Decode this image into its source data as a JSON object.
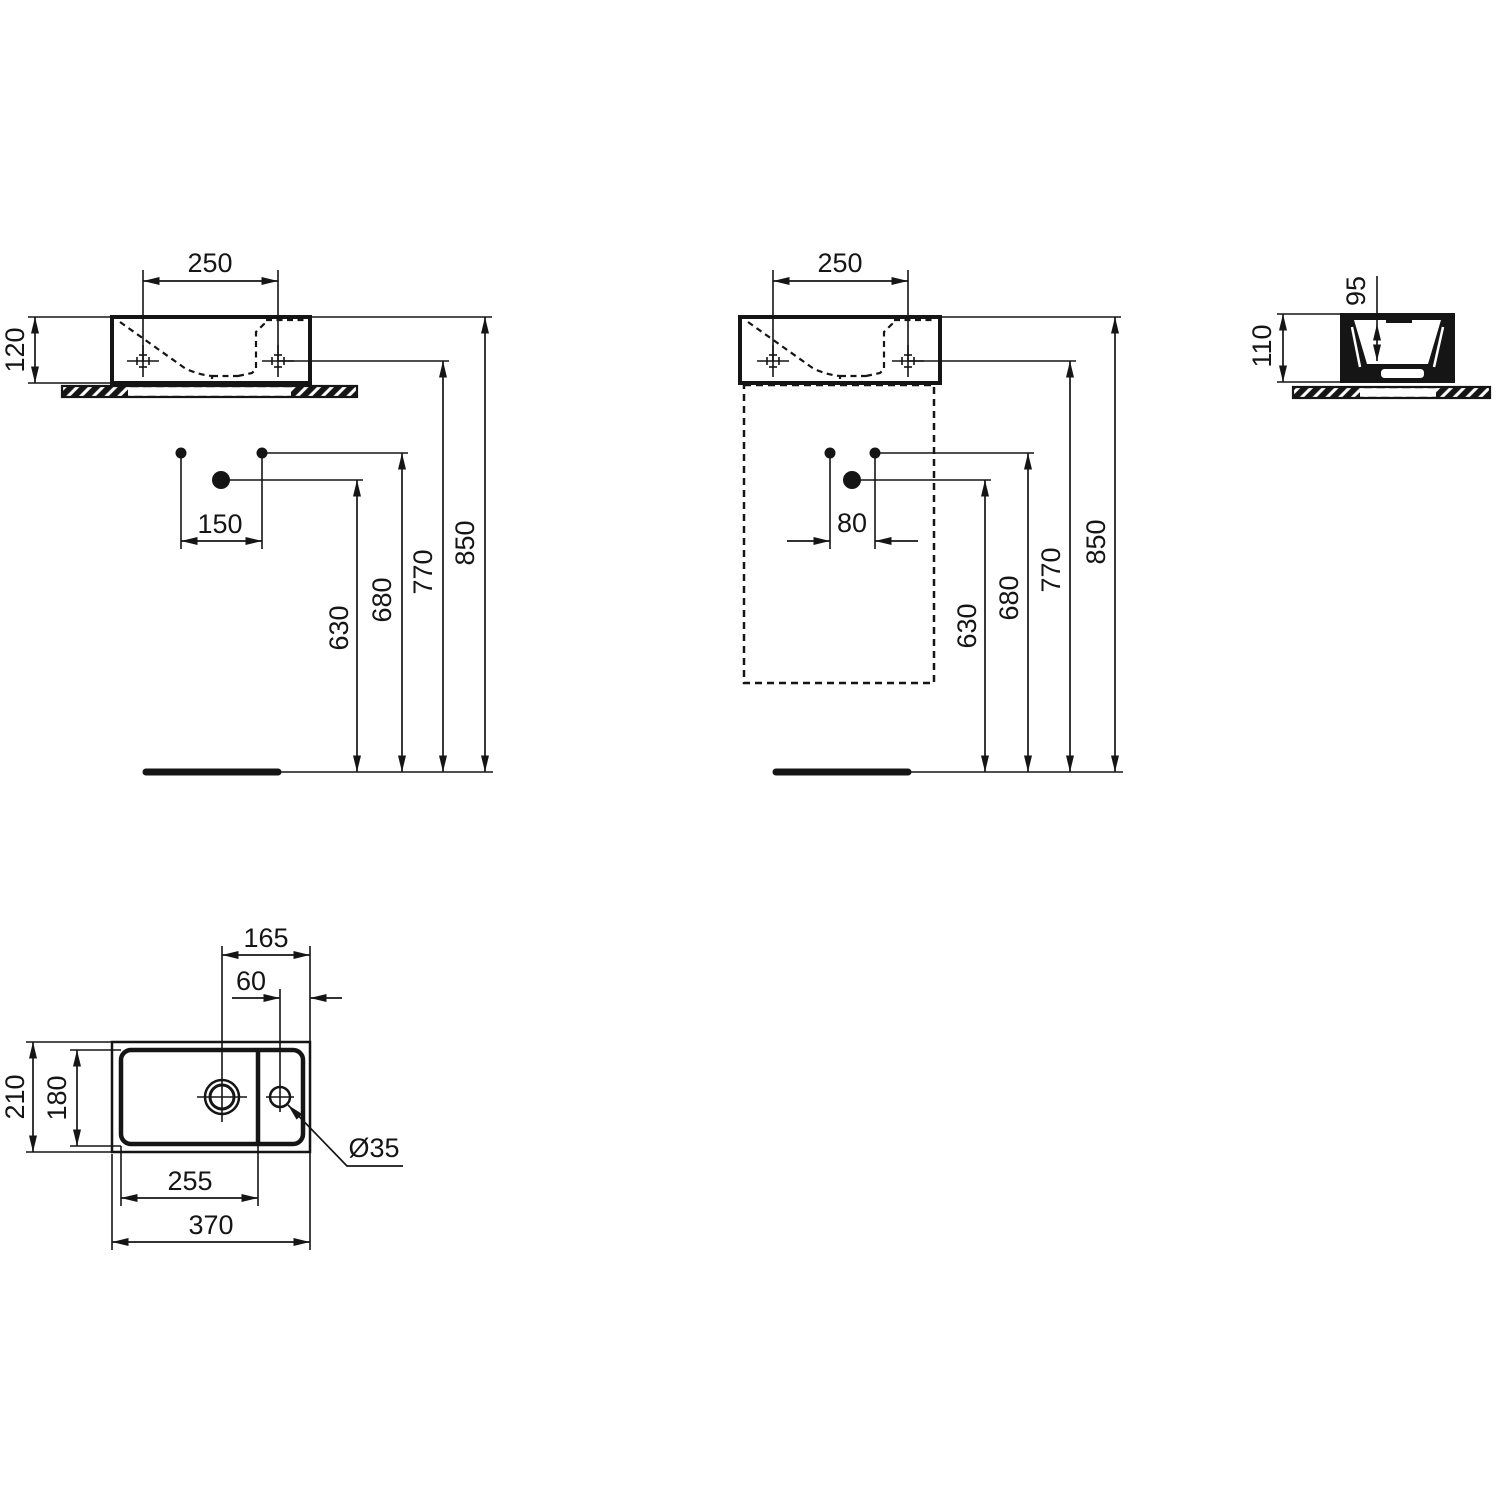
{
  "palette": {
    "line": "#151515",
    "background": "#ffffff"
  },
  "views": {
    "front_wall": {
      "hole_spacing": "250",
      "basin_height": "120",
      "drain_offset": "150",
      "drain_height": "630",
      "trap_height": "680",
      "hole_height": "770",
      "rim_height": "850"
    },
    "front_cabinet": {
      "hole_spacing": "250",
      "drain_offset": "80",
      "drain_height": "630",
      "trap_height": "680",
      "hole_height": "770",
      "rim_height": "850"
    },
    "side": {
      "basin_height": "110",
      "bowl_depth": "95"
    },
    "plan": {
      "drain_to_edge": "165",
      "taphole_to_edge": "60",
      "overall_depth": "210",
      "bowl_depth": "180",
      "bowl_width": "255",
      "overall_width": "370",
      "taphole_diameter": "Ø35"
    }
  }
}
